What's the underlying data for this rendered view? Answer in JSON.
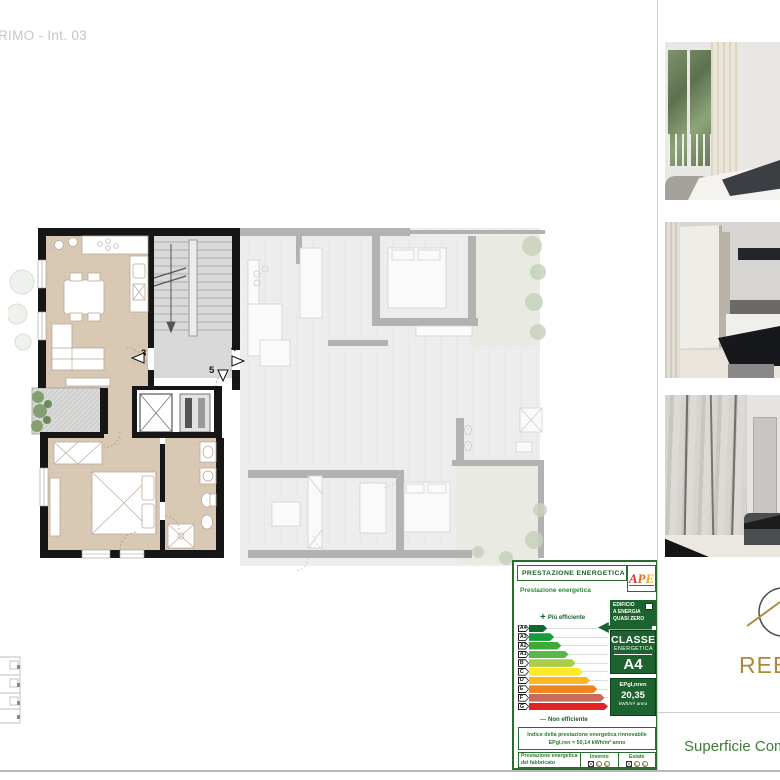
{
  "page": {
    "title_partial": "RIMO - Int. 03"
  },
  "plan": {
    "entrances": [
      {
        "number": "3"
      },
      {
        "number": "4"
      },
      {
        "number": "5"
      }
    ]
  },
  "certificate": {
    "title": "PRESTAZIONE ENERGETICA",
    "ape_letters": [
      "A",
      "P",
      "E"
    ],
    "subtitle": "Prestazione energetica",
    "nzeb_line1": "EDIFICIO",
    "nzeb_line2": "A ENERGIA",
    "nzeb_line3": "QUASI ZERO",
    "more_efficient": "Più efficiente",
    "less_efficient": "Non efficiente",
    "class_box_line1": "CLASSE",
    "class_box_line2": "ENERGETICA",
    "class_value": "A4",
    "ep_label": "EPgl,nren",
    "ep_value": "20,35",
    "ep_unit": "kWh/m² anno",
    "classes": [
      {
        "label": "A4",
        "color": "#0a6b2d",
        "width": 20
      },
      {
        "label": "A3",
        "color": "#169c38",
        "width": 28
      },
      {
        "label": "A2",
        "color": "#3dab35",
        "width": 36
      },
      {
        "label": "A1",
        "color": "#56b94a",
        "width": 44
      },
      {
        "label": "B",
        "color": "#a8cf45",
        "width": 52
      },
      {
        "label": "C",
        "color": "#ffe926",
        "width": 60
      },
      {
        "label": "D",
        "color": "#fbb724",
        "width": 68
      },
      {
        "label": "E",
        "color": "#ee8522",
        "width": 76
      },
      {
        "label": "F",
        "color": "#c96a5c",
        "width": 84
      },
      {
        "label": "G",
        "color": "#e32322",
        "width": 94
      }
    ],
    "renewable_line1": "Indice della prestazione energetica rinnovabile",
    "renewable_line2": "EPgl,ren = 50,14 kWh/m² anno",
    "building_performance": "Prestazione energetica del fabbricato",
    "winter_label": "Inverno",
    "summer_label": "Estate",
    "accent_green": "#1d6330"
  },
  "brand": {
    "logo_text_partial": "REB",
    "footer_label_partial": "Superficie Comm",
    "gold": "#ab8a3e"
  }
}
